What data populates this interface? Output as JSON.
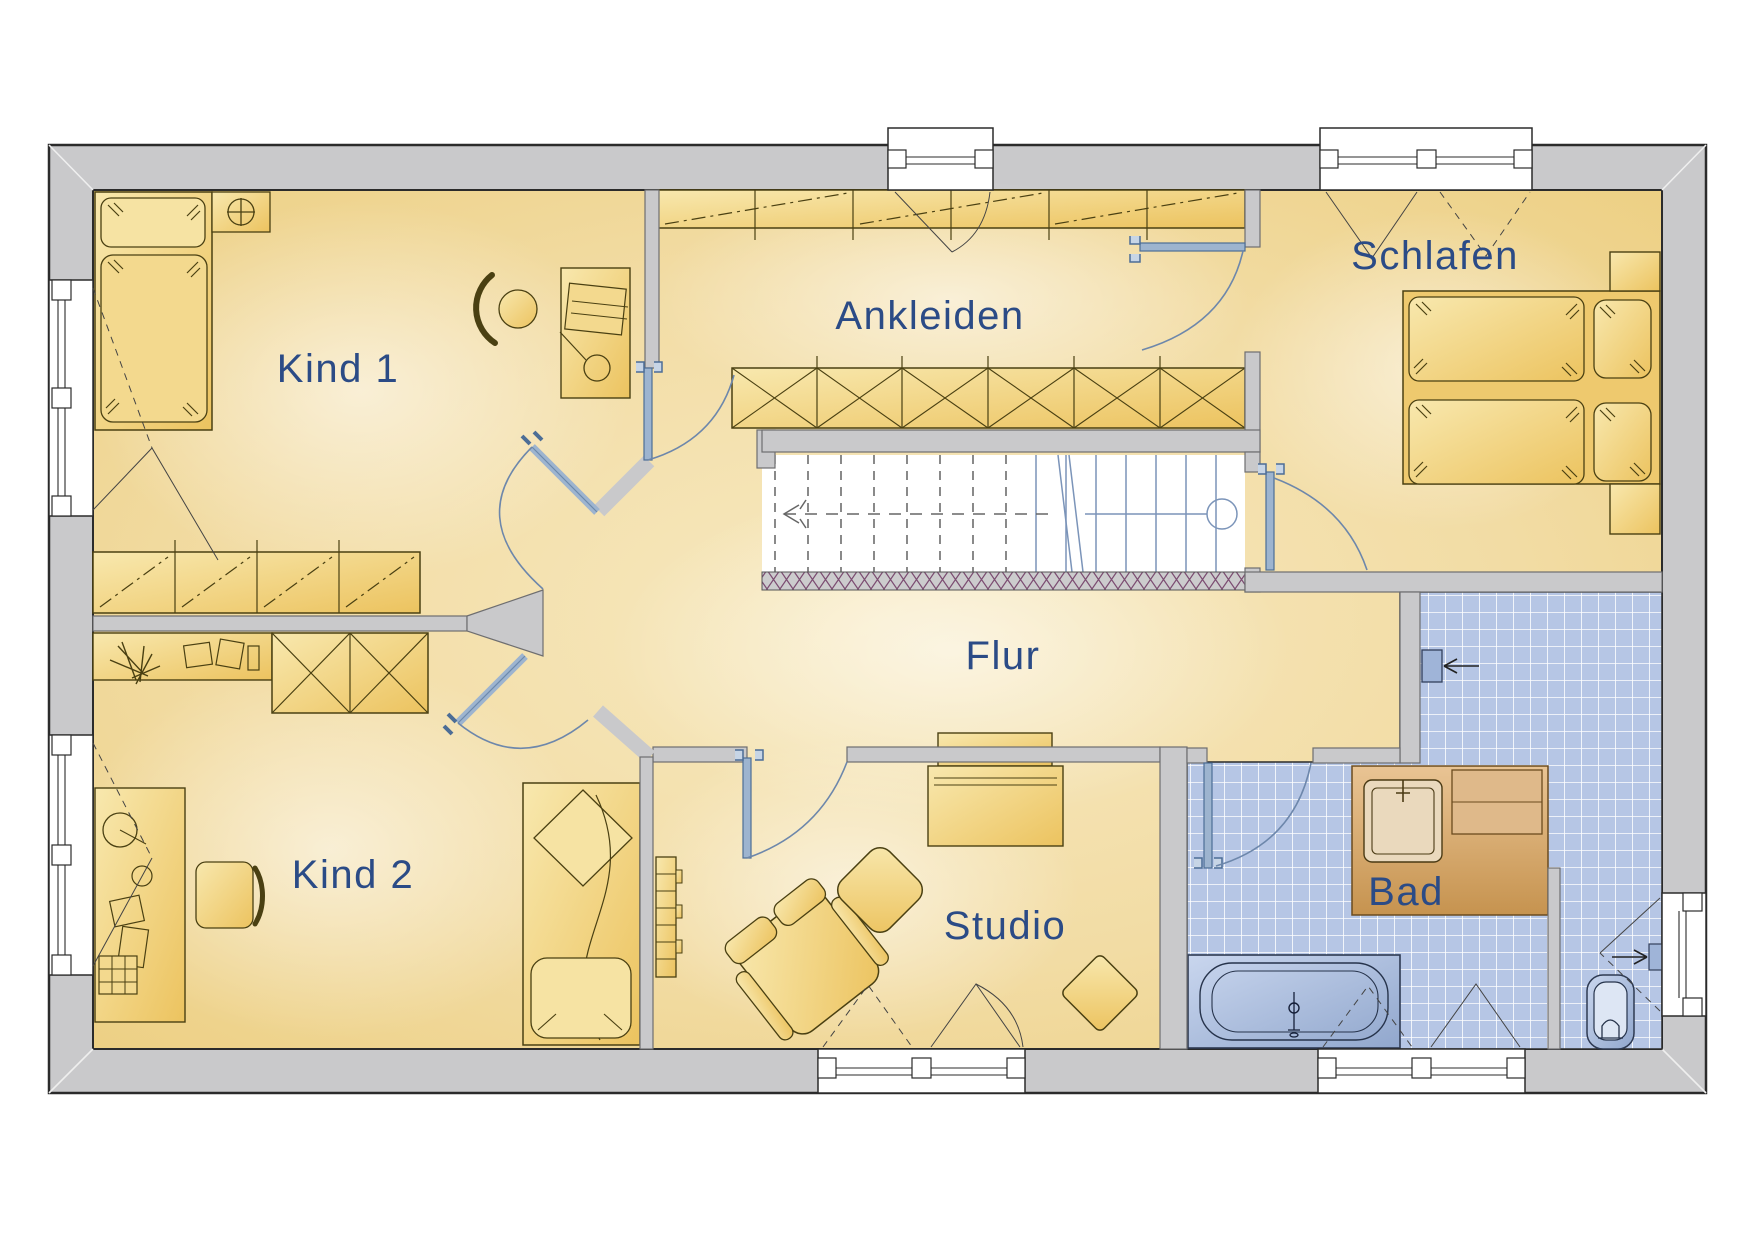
{
  "plan": {
    "type": "floor-plan",
    "rooms": [
      {
        "id": "kind1",
        "label": "Kind 1"
      },
      {
        "id": "ankleiden",
        "label": "Ankleiden"
      },
      {
        "id": "schlafen",
        "label": "Schlafen"
      },
      {
        "id": "flur",
        "label": "Flur"
      },
      {
        "id": "kind2",
        "label": "Kind 2"
      },
      {
        "id": "studio",
        "label": "Studio"
      },
      {
        "id": "bad",
        "label": "Bad"
      }
    ],
    "colors": {
      "wall_fill": "#c9c9cb",
      "outline": "#2b2b2b",
      "floor_edge": "#ecce7f",
      "floor_center": "#faf0cd",
      "furniture_fill": "#eecb6e",
      "furniture_outline": "#4a4012",
      "label_blue": "#2b4b86",
      "door_leaf": "#9db4cf",
      "door_arc": "#6d87ab",
      "tile_blue": "#b6c6e5",
      "fixture_blue": "#c2d0ea",
      "tub_blue": "#9fb4d8",
      "vanity_tan": "#d2a86e",
      "railing_hatch": "#7c4d72",
      "stair_tread_blue": "#7b94b9"
    }
  }
}
